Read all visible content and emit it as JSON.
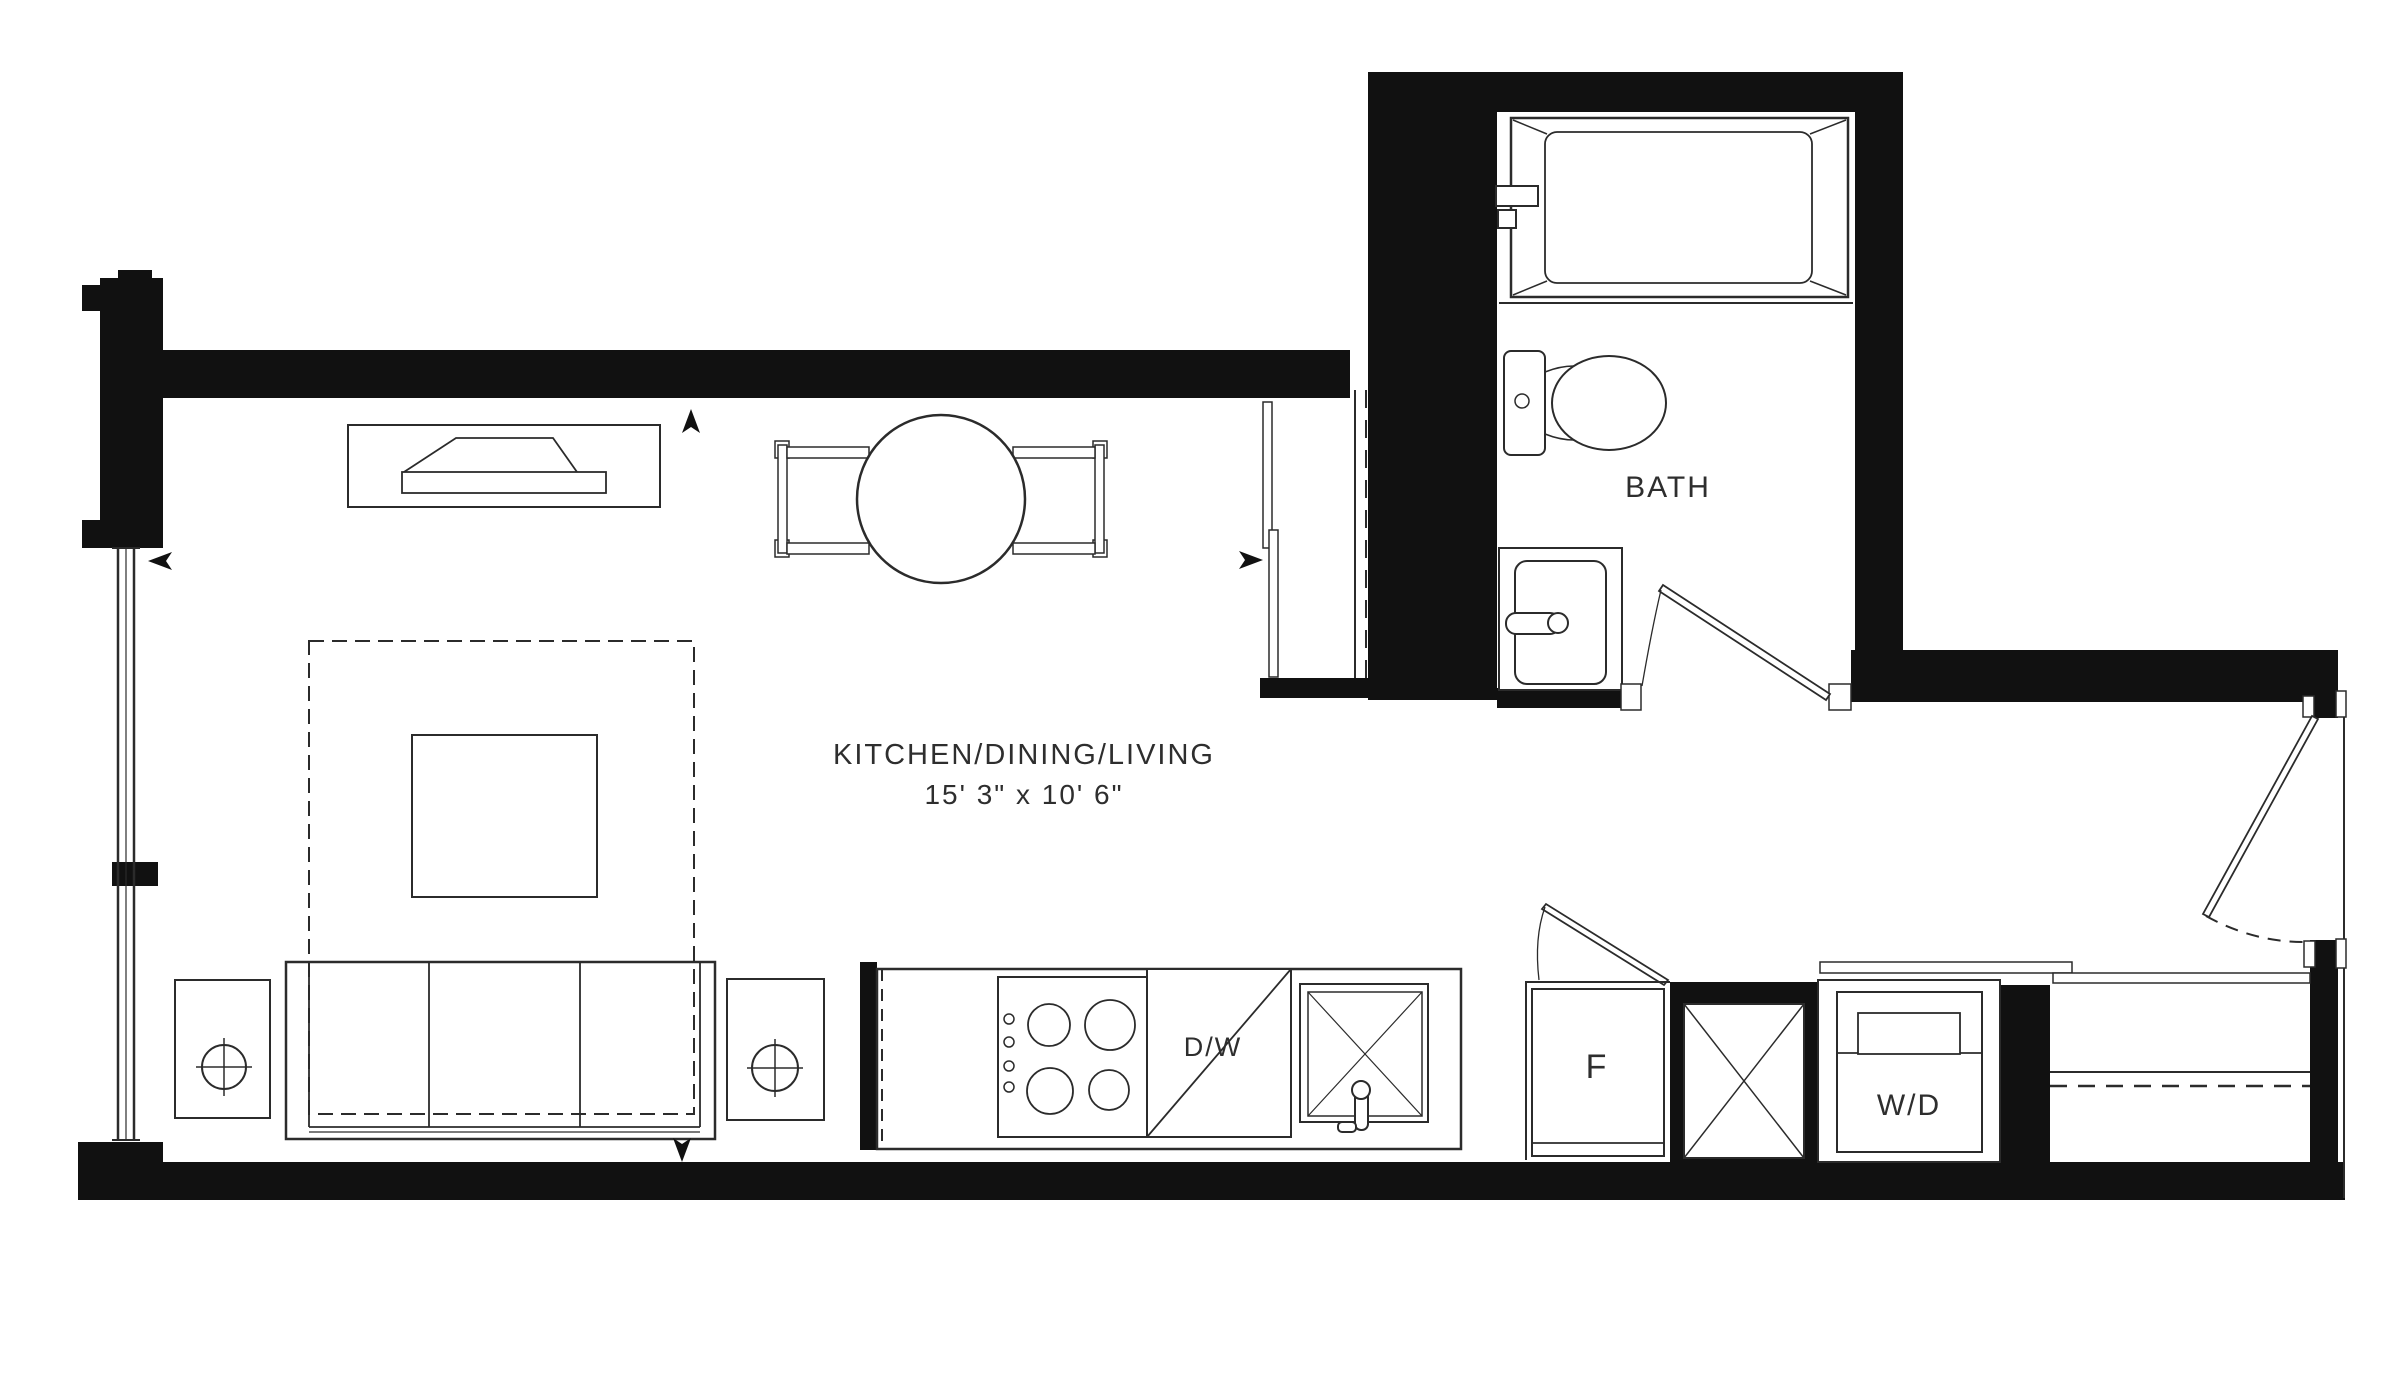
{
  "plan": {
    "title": "Studio suite floor plan",
    "rooms": {
      "bath": {
        "label": "BATH"
      },
      "main": {
        "label": "KITCHEN/DINING/LIVING",
        "dimensions": "15' 3\" x 10' 6\""
      }
    },
    "appliances": {
      "dishwasher": {
        "label": "D/W"
      },
      "fridge": {
        "label": "F"
      },
      "washer_dryer": {
        "label": "W/D"
      }
    },
    "colors": {
      "walls": "#111111",
      "lines": "#2b2b2b",
      "background": "#ffffff"
    }
  }
}
